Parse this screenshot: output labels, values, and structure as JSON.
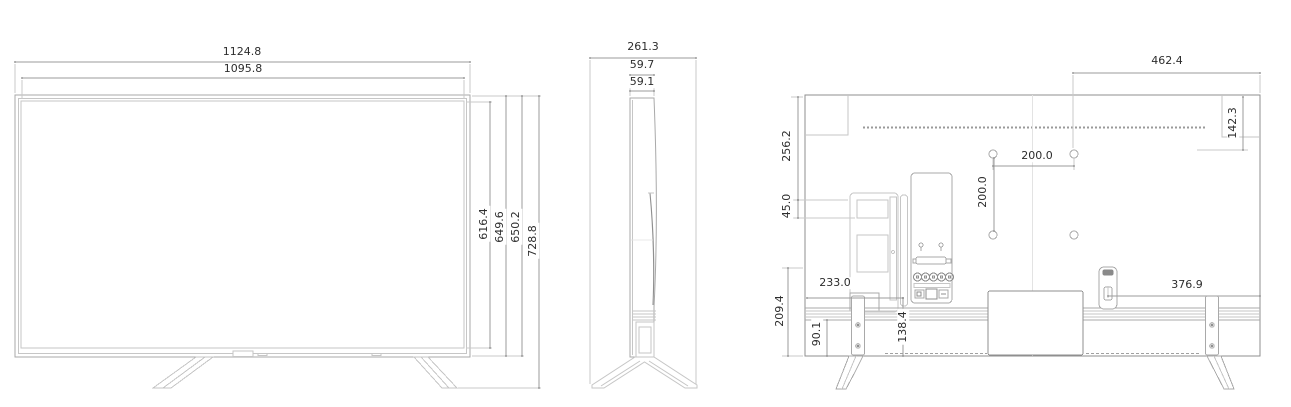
{
  "diagram": {
    "subject": "tv-dimension-drawing",
    "line_color": "#a9a9a9",
    "text_color": "#2d2d2d",
    "background": "#ffffff",
    "views": {
      "front": {
        "width_outer": "1124.8",
        "width_inner": "1095.8",
        "height_inner": "616.4",
        "height_mid": "649.6",
        "height_body": "650.2",
        "height_total": "728.8"
      },
      "side": {
        "depth_total": "261.3",
        "thickness_outer": "59.7",
        "thickness_inner": "59.1"
      },
      "back": {
        "vesa_to_edge": "462.4",
        "top_to_vesa": "142.3",
        "top_to_module": "256.2",
        "module_offset": "45.0",
        "vesa_horizontal": "200.0",
        "vesa_vertical": "200.0",
        "jacks_from_left": "233.0",
        "jacks_from_bottom": "138.4",
        "bottom_section": "209.4",
        "rail_section": "90.1",
        "holder_to_edge": "376.9"
      }
    }
  }
}
